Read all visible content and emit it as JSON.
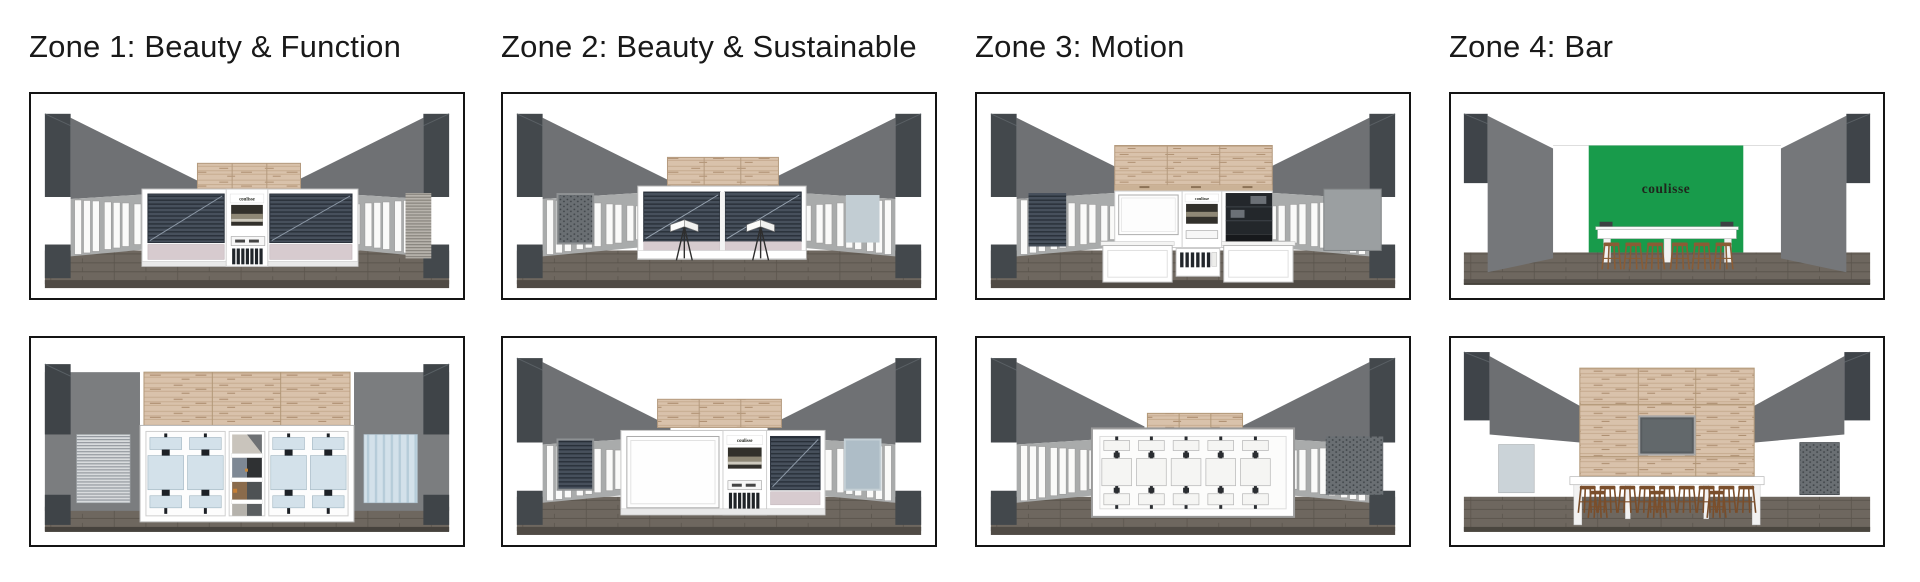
{
  "page": {
    "background": "#FFFFFF"
  },
  "brand": {
    "logo_text": "coulisse"
  },
  "palette": {
    "green": "#189B4B",
    "wall_gray": "#6F7174",
    "pillar_dark": "#43484C",
    "floor_brown": "#6E675F",
    "wood_beige": "#D9C2AB",
    "blind_slate": "#47505C",
    "fabric_pink": "#D7CBCF",
    "glass_blue": "#D3E1EA",
    "stool_wood": "#8A5C35"
  },
  "zones": [
    {
      "title": "Zone 1: Beauty & Function"
    },
    {
      "title": "Zone 2: Beauty & Sustainable"
    },
    {
      "title": "Zone 3: Motion"
    },
    {
      "title": "Zone 4: Bar"
    }
  ]
}
